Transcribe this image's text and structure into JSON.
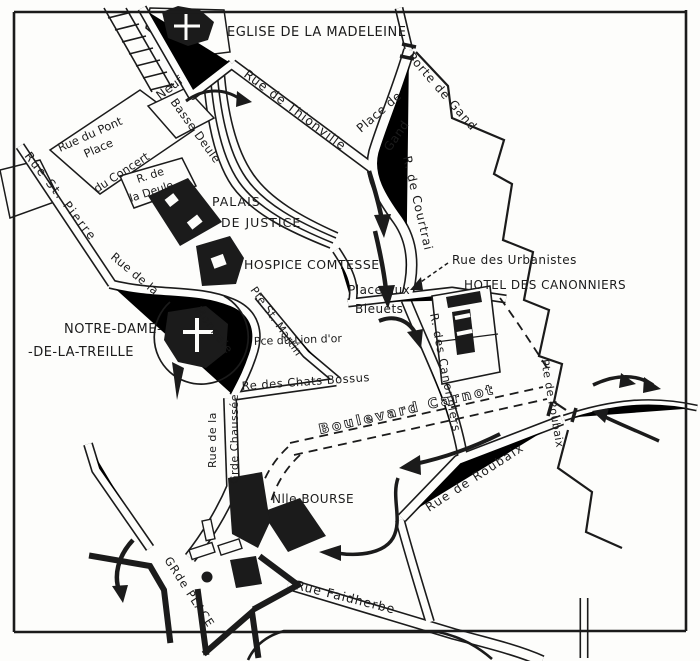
{
  "colors": {
    "ink": "#1b1b1b",
    "paper": "#fdfdfb"
  },
  "map": {
    "kind": "engraved-street-map",
    "labels": [
      {
        "name": "eglise-madeleine",
        "text": "EGLISE DE LA MADELEINE",
        "x": 227,
        "y": 36,
        "rotate": 0,
        "size": 13,
        "spacing": 0.5
      },
      {
        "name": "porte-de-gand",
        "text": "Porte de Gand",
        "x": 407,
        "y": 57,
        "rotate": 49,
        "size": 12,
        "spacing": 1
      },
      {
        "name": "place-de",
        "text": "Place de",
        "x": 361,
        "y": 133,
        "rotate": -41,
        "size": 12,
        "spacing": 0.5
      },
      {
        "name": "gand",
        "text": "Gand",
        "x": 390,
        "y": 152,
        "rotate": -55,
        "size": 12,
        "spacing": 0.5
      },
      {
        "name": "rue-de-courtrai",
        "text": "R. de Courtrai",
        "x": 403,
        "y": 157,
        "rotate": 77,
        "size": 12,
        "spacing": 1
      },
      {
        "name": "rue-de-thionville",
        "text": "Rue de Thionville",
        "x": 243,
        "y": 76,
        "rotate": 37,
        "size": 12.5,
        "spacing": 1
      },
      {
        "name": "pont-neuf",
        "text": "Neuf",
        "x": 160,
        "y": 100,
        "rotate": -37,
        "size": 12,
        "spacing": 0.5
      },
      {
        "name": "basse-deule",
        "text": "Basse Deule",
        "x": 170,
        "y": 102,
        "rotate": 54,
        "size": 11.5,
        "spacing": 0.5
      },
      {
        "name": "rue-du-pont",
        "text": "Rue du Pont",
        "x": 60,
        "y": 152,
        "rotate": -24,
        "size": 11.5,
        "spacing": 0
      },
      {
        "name": "place-du-concert-1",
        "text": "Place",
        "x": 86,
        "y": 158,
        "rotate": -24,
        "size": 11.5,
        "spacing": 0
      },
      {
        "name": "place-du-concert-2",
        "text": "du Concert",
        "x": 97,
        "y": 193,
        "rotate": -33,
        "size": 11.5,
        "spacing": 0
      },
      {
        "name": "r-de-la-deule-1",
        "text": "R. de",
        "x": 138,
        "y": 183,
        "rotate": -18,
        "size": 11,
        "spacing": 0
      },
      {
        "name": "r-de-la-deule-2",
        "text": "la Deule",
        "x": 131,
        "y": 202,
        "rotate": -18,
        "size": 11,
        "spacing": 0
      },
      {
        "name": "rue-st-pierre",
        "text": "Rue St. Pierre",
        "x": 24,
        "y": 156,
        "rotate": 52,
        "size": 12,
        "spacing": 2
      },
      {
        "name": "rue-de-la-monnaie-1",
        "text": "Rue de la",
        "x": 110,
        "y": 258,
        "rotate": 40,
        "size": 11.5,
        "spacing": 0.5
      },
      {
        "name": "rue-de-la-monnaie-2",
        "text": "Monnaie",
        "x": 194,
        "y": 310,
        "rotate": 53,
        "size": 11.5,
        "spacing": 1
      },
      {
        "name": "palais-1",
        "text": "PALAIS",
        "x": 212,
        "y": 206,
        "rotate": 0,
        "size": 12.5,
        "spacing": 1
      },
      {
        "name": "palais-2",
        "text": "DE JUSTICE",
        "x": 221,
        "y": 227,
        "rotate": 0,
        "size": 12.5,
        "spacing": 1
      },
      {
        "name": "hospice-comtesse",
        "text": "HOSPICE COMTESSE",
        "x": 244,
        "y": 269,
        "rotate": 0,
        "size": 12.5,
        "spacing": 0.5
      },
      {
        "name": "pte-st-martin",
        "text": "Pte St. Martin",
        "x": 250,
        "y": 290,
        "rotate": 55,
        "size": 11,
        "spacing": 0.5
      },
      {
        "name": "notre-dame-1",
        "text": "NOTRE-DAME-",
        "x": 64,
        "y": 333,
        "rotate": 0,
        "size": 13,
        "spacing": 0.5
      },
      {
        "name": "notre-dame-2",
        "text": "-DE-LA-TREILLE",
        "x": 28,
        "y": 356,
        "rotate": 0,
        "size": 13,
        "spacing": 0.5
      },
      {
        "name": "pce-du-lion-dor",
        "text": "Pce du Lion d'or",
        "x": 254,
        "y": 345,
        "rotate": -2,
        "size": 11,
        "spacing": 0
      },
      {
        "name": "rue-des-chats-bossus",
        "text": "Re des Chats Bossus",
        "x": 242,
        "y": 390,
        "rotate": -4,
        "size": 11.5,
        "spacing": 0.5
      },
      {
        "name": "place-aux-bleuets-1",
        "text": "Place aux",
        "x": 348,
        "y": 294,
        "rotate": 0,
        "size": 12,
        "spacing": 0.5
      },
      {
        "name": "place-aux-bleuets-2",
        "text": "Bleuets",
        "x": 355,
        "y": 313,
        "rotate": 0,
        "size": 12,
        "spacing": 0.5
      },
      {
        "name": "rue-des-urbanistes",
        "text": "Rue des Urbanistes",
        "x": 452,
        "y": 264,
        "rotate": 0,
        "size": 12,
        "spacing": 0.5
      },
      {
        "name": "hotel-des-canonniers",
        "text": "HOTEL DES CANONNIERS",
        "x": 464,
        "y": 289,
        "rotate": 0,
        "size": 12,
        "spacing": 0.5
      },
      {
        "name": "r-des-canonniers",
        "text": "R. des Canonniers",
        "x": 430,
        "y": 314,
        "rotate": 79,
        "size": 11.5,
        "spacing": 1
      },
      {
        "name": "boulevard-carnot",
        "text": "Boulevard Carnot",
        "x": 320,
        "y": 434,
        "rotate": -13,
        "size": 13.5,
        "spacing": 3,
        "style": "outline"
      },
      {
        "name": "rue-de-roubaix",
        "text": "Rue de Roubaix",
        "x": 429,
        "y": 512,
        "rotate": -33,
        "size": 12,
        "spacing": 1.5
      },
      {
        "name": "pte-de-roubaix",
        "text": "Pte de Roubaix",
        "x": 541,
        "y": 360,
        "rotate": 80,
        "size": 11,
        "spacing": 0.5
      },
      {
        "name": "rue-de-la-gr-chaussee-1",
        "text": "Rue de la",
        "x": 216,
        "y": 468,
        "rotate": -90,
        "size": 11,
        "spacing": 0.5
      },
      {
        "name": "rue-de-la-gr-chaussee-2",
        "text": "Grde Chaussée",
        "x": 238,
        "y": 484,
        "rotate": -90,
        "size": 11,
        "spacing": 0.5
      },
      {
        "name": "nouvelle-bourse",
        "text": "Nlle BOURSE",
        "x": 272,
        "y": 503,
        "rotate": 0,
        "size": 12,
        "spacing": 0.5
      },
      {
        "name": "grande-place",
        "text": "GRde PLACE",
        "x": 164,
        "y": 560,
        "rotate": 57,
        "size": 11.5,
        "spacing": 1
      },
      {
        "name": "rue-faidherbe",
        "text": "Rue Faidherbe",
        "x": 295,
        "y": 589,
        "rotate": 14,
        "size": 12.5,
        "spacing": 1
      }
    ]
  }
}
